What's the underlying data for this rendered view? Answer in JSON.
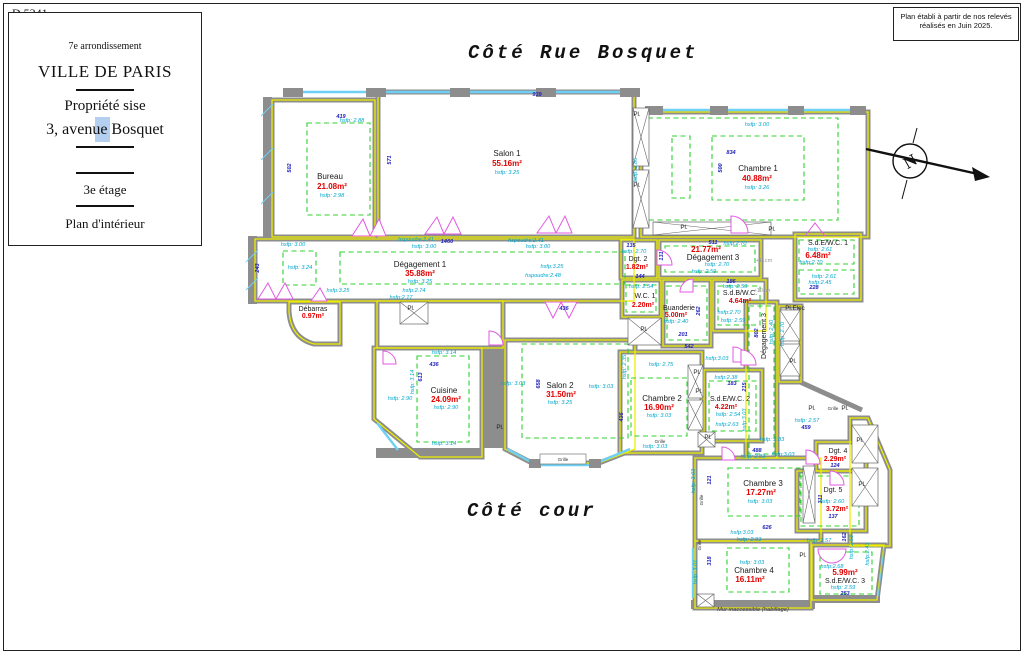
{
  "page": {
    "ref": "D.5341",
    "titleBlock": {
      "arrondissement": "7e arrondissement",
      "city": "VILLE DE PARIS",
      "propriete": "Propriété sise",
      "adresse": "3, avenue Bosquet",
      "etage": "3e étage",
      "planType": "Plan d'intérieur"
    },
    "noteLine1": "Plan établi à partir de nos relevés",
    "noteLine2": "réalisés en Juin 2025.",
    "coteRue": "Côté Rue Bosquet",
    "coteCour": "Côté cour",
    "north": "N",
    "murNote": "Mur inaccessible (habillage)"
  },
  "rooms": {
    "salon1": {
      "name": "Salon 1",
      "area": "55.16m²",
      "h": "hsfp: 3.25"
    },
    "chambre1": {
      "name": "Chambre 1",
      "area": "40.88m²",
      "h": "hsfp: 3.26"
    },
    "bureau": {
      "name": "Bureau",
      "area": "21.08m²",
      "h": "hsfp: 2.98"
    },
    "deg1": {
      "name": "Dégagement 1",
      "area": "35.88m²",
      "h": "hsfp: 3.25"
    },
    "debarras": {
      "name": "Débarras",
      "area": "0.97m²"
    },
    "dgt2": {
      "name": "Dgt. 2",
      "area": "1.82m²"
    },
    "deg3": {
      "name": "Dégagement 3",
      "area": "21.77m²",
      "h": "hsfp: 2.70",
      "h2": "hsfp: 2.59"
    },
    "sdewc1": {
      "name": "S.d.E/W.C. 1",
      "area": "6.48m²",
      "h": "hsfp: 2.61",
      "h2": "hsfp:2.70"
    },
    "wc1": {
      "name": "W.C. 1",
      "area": "2.20m²",
      "h": "hsfp: 2.54"
    },
    "buanderie": {
      "name": "Buanderie",
      "area": "5.00m²",
      "h": "hsfp: 2.40"
    },
    "sdbwc": {
      "name": "S.d.B/W.C.",
      "area": "4.64m²",
      "h": "hsfp: 2.59",
      "h2": "hsfp:2.70"
    },
    "cuisine": {
      "name": "Cuisine",
      "area": "24.09m²",
      "h": "hsfp: 2.90"
    },
    "salon2": {
      "name": "Salon 2",
      "area": "31.50m²",
      "h": "hsfp: 3.25"
    },
    "chambre2": {
      "name": "Chambre 2",
      "area": "16.90m²",
      "h": "hsfp: 3.03"
    },
    "sdewc2": {
      "name": "S.d.E/W.C. 2",
      "area": "4.22m²",
      "h": "hsfp: 2.54",
      "h2": "hsfp:2.63"
    },
    "chambre3": {
      "name": "Chambre 3",
      "area": "17.27m²",
      "h": "hsfp: 3.03"
    },
    "dgt4": {
      "name": "Dgt. 4",
      "area": "2.29m²"
    },
    "dgt5": {
      "name": "Dgt. 5",
      "area": "3.72m²",
      "h": "hsfp: 2.60"
    },
    "chambre4": {
      "name": "Chambre 4",
      "area": "16.11m²",
      "h": "hsfp: 3.03"
    },
    "sdewc3": {
      "name": "S.d.E/W.C. 3",
      "area": "5.99m²",
      "h": "hsfp: 2.59",
      "h2": "hsfp:2.68"
    }
  },
  "dims": {
    "d939": "939",
    "d571": "571",
    "d419": "419",
    "d502": "502",
    "d243": "243",
    "d1460": "1460",
    "d834": "834",
    "d500": "500",
    "d135": "135",
    "d511": "511",
    "d131": "131",
    "d144": "144",
    "d186": "186",
    "d262": "262",
    "d201": "201",
    "d542": "542",
    "d436a": "436",
    "d436b": "436",
    "d436c": "436",
    "d613": "613",
    "d658": "658",
    "d183": "183",
    "d215": "215",
    "d802": "802",
    "d488": "488",
    "d459": "459",
    "d124": "124",
    "d311": "311",
    "d137": "137",
    "d626": "626",
    "d318": "318",
    "d121": "121",
    "d253": "253",
    "d228": "228",
    "d162": "162"
  },
  "heights": {
    "h288": "hsfp: 2.88",
    "h300": "hsfp: 3.00",
    "h324": "hsfp: 3.24",
    "h325": "hsfp:3.25",
    "hsp241": "hspoudre:2.41",
    "hsp248": "hspoudre:2.48",
    "h286": "hsfp: 2.86",
    "h270": "hsfp: 2.70",
    "h270b": "hsfp:2.70",
    "h274": "hsfp:2.74",
    "h217": "hsfp:2.17",
    "h314": "hsfp: 3.14",
    "h290": "hsfp: 2.90",
    "h303": "hsfp: 3.03",
    "h303b": "hsfp:3.03",
    "h275": "hsfp: 2.75",
    "h235": "hsfp: 2.35",
    "h238": "hsfp:2.38",
    "h283": "hsfp: 2.83",
    "h257": "hsfp: 2.57",
    "h258": "hsfp: 2.58",
    "h243": "hsfp:2.43",
    "h261": "hsfp: 2.61",
    "h245": "hsfp:2.45",
    "h240": "hsfp: 2.40",
    "h259": "hsfp: 2.59",
    "h301": "hsfp: 3.01"
  },
  "labels": {
    "pl": "Pl.",
    "plElec": "Pl.Elec",
    "grille": "Grille",
    "plus10": "+10cm",
    "plus11": "+11cm"
  }
}
